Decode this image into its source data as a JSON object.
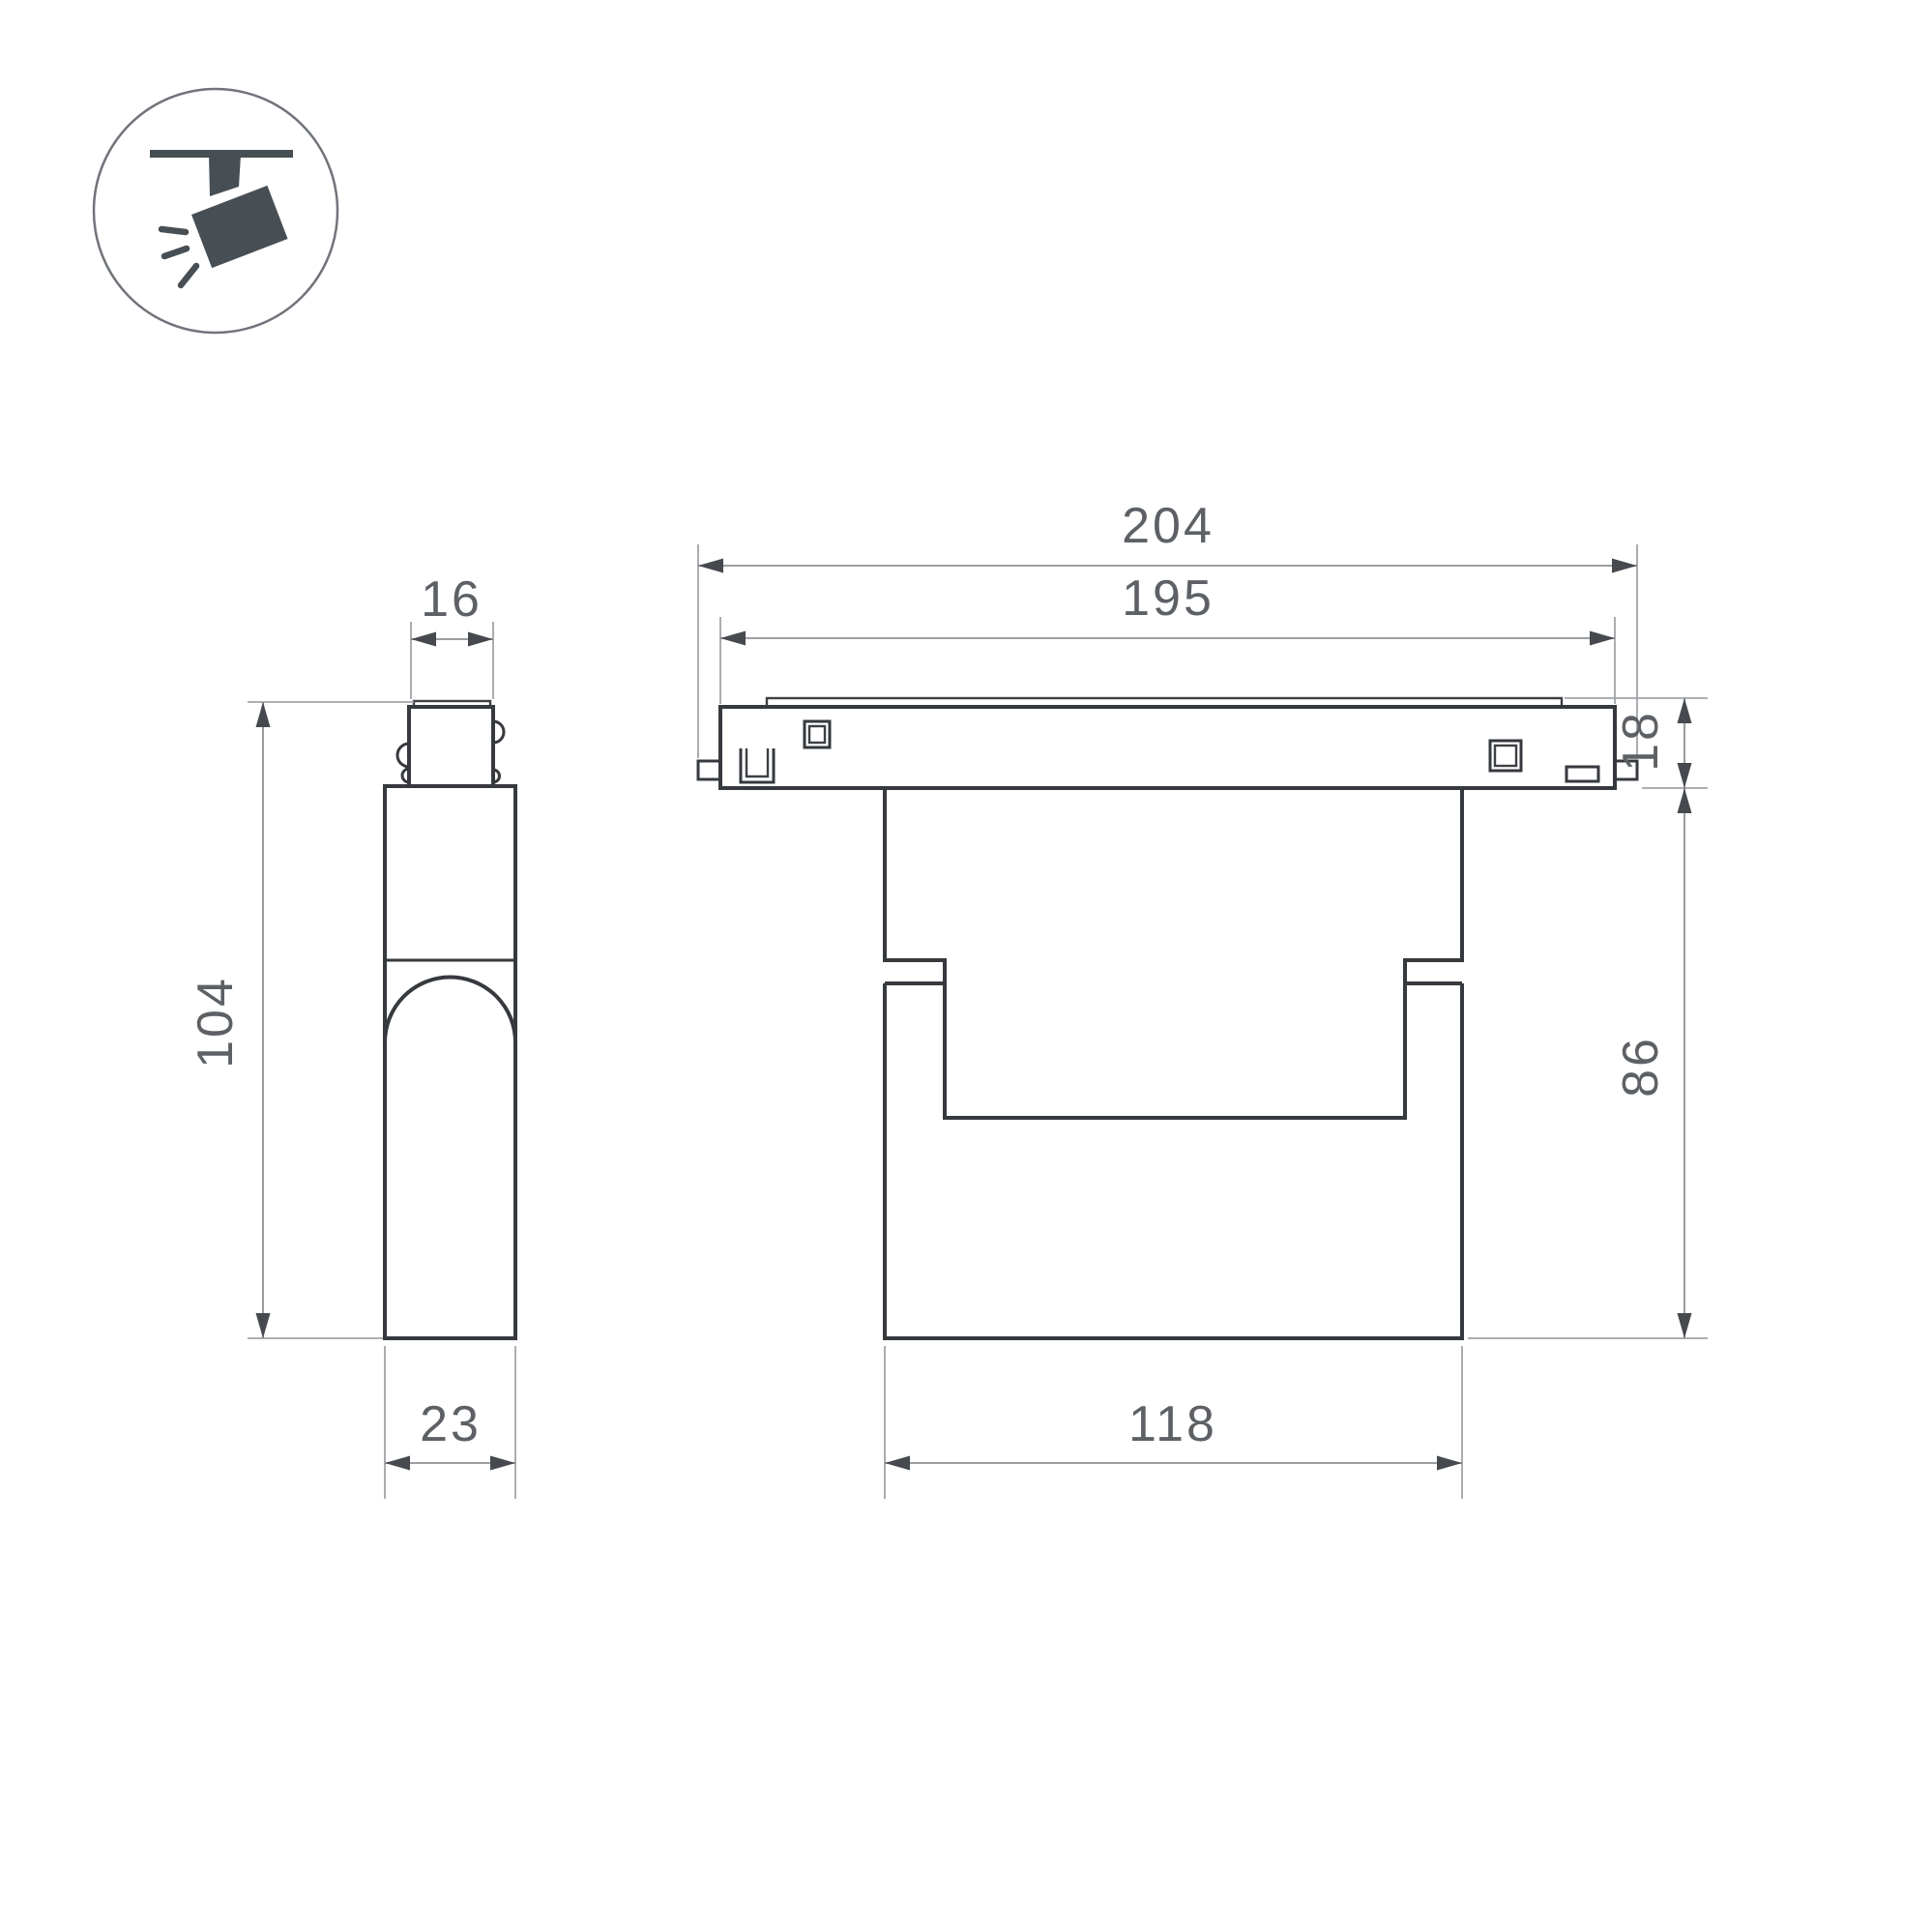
{
  "page": {
    "background": "#ffffff"
  },
  "colors": {
    "object_line": "#36393d",
    "dimension_line": "#8d9195",
    "extension_line": "#a0a4a8",
    "arrowhead": "#46494d",
    "label_text": "#5d6165",
    "icon_dark": "#474e54"
  },
  "icon": {
    "name": "ceiling-track-spotlight"
  },
  "views": {
    "side": {
      "name": "side-view"
    },
    "front": {
      "name": "front-view"
    }
  },
  "dimensions": {
    "side_top_width": "16",
    "side_height": "104",
    "side_depth": "23",
    "total_width": "204",
    "track_width": "195",
    "track_height": "18",
    "body_height": "86",
    "body_width": "118"
  }
}
